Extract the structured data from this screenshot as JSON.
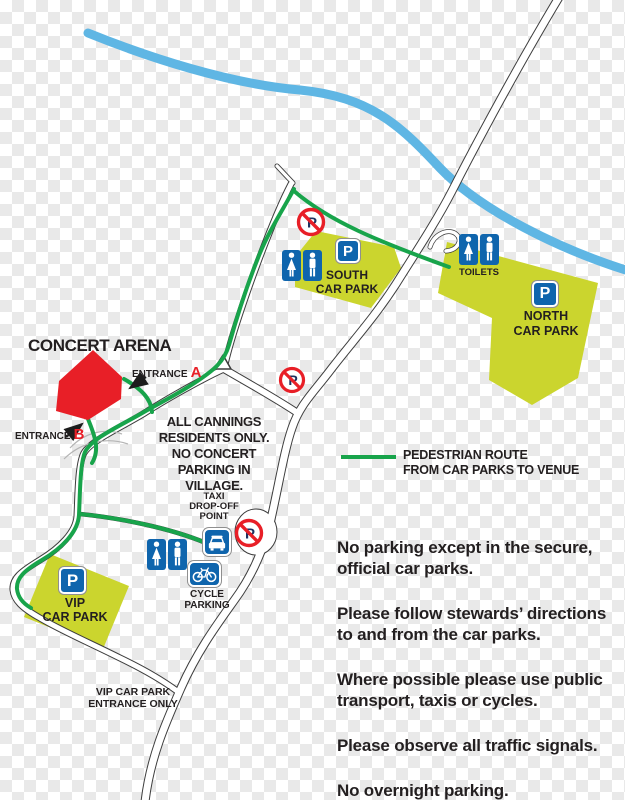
{
  "map": {
    "title": "CONCERT ARENA",
    "entrance_label": "ENTRANCE",
    "entrance_a": "A",
    "entrance_b": "B",
    "village_note": [
      "ALL CANNINGS",
      "RESIDENTS ONLY.",
      "NO CONCERT",
      "PARKING IN VILLAGE."
    ],
    "south_car_park": [
      "SOUTH",
      "CAR PARK"
    ],
    "north_car_park": [
      "NORTH",
      "CAR PARK"
    ],
    "vip_car_park": [
      "VIP",
      "CAR PARK"
    ],
    "toilets_label": "TOILETS",
    "taxi_point": [
      "TAXI",
      "DROP-OFF",
      "POINT"
    ],
    "cycle_parking": [
      "CYCLE",
      "PARKING"
    ],
    "vip_entrance": [
      "VIP CAR PARK",
      "ENTRANCE ONLY"
    ]
  },
  "legend": {
    "lines": [
      "PEDESTRIAN ROUTE",
      "FROM CAR PARKS TO VENUE"
    ]
  },
  "notices": [
    [
      "No parking except in the secure,",
      "official car parks."
    ],
    [
      "Please follow stewards’ directions",
      "to and from the car parks."
    ],
    [
      "Where possible please use public",
      "transport, taxis or cycles."
    ],
    [
      "Please observe all traffic signals."
    ],
    [
      "No overnight parking."
    ]
  ],
  "icons": {
    "parking_letter": "P",
    "no_parking_letter": "P",
    "parking_sign": "parking-sign-icon",
    "no_parking_sign": "no-parking-icon",
    "toilets": [
      "female-icon",
      "male-icon"
    ],
    "taxi": "taxi-icon",
    "cycle": "bicycle-icon"
  },
  "colors": {
    "route_green": "#18a44b",
    "river_blue": "#5fb6e4",
    "carpark_lime": "#cbd52e",
    "arena_red": "#e81f27",
    "sign_blue": "#0f65ad",
    "no_parking_navy": "#1d3260",
    "road_casing": "#3d3d3d"
  }
}
